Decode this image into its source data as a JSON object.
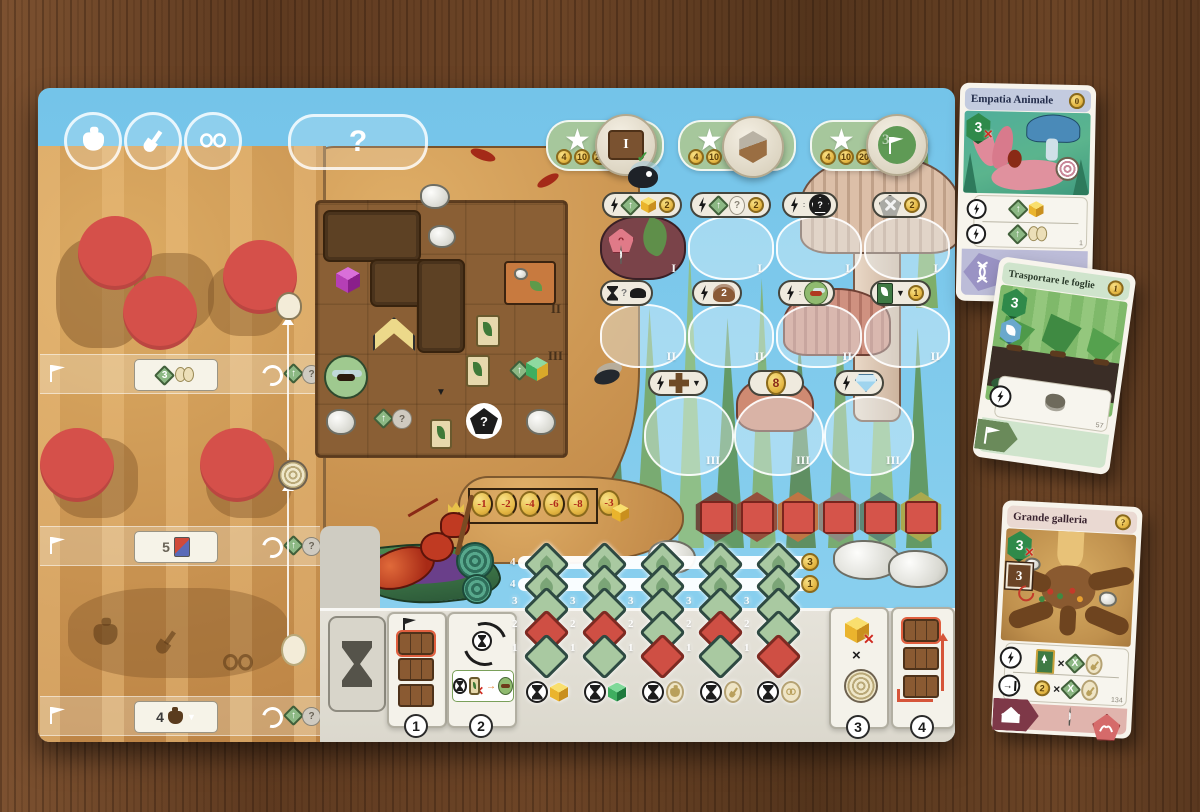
{
  "icons": {
    "question": "?",
    "star": "★",
    "up": "↑",
    "down": "▼",
    "check": "✓",
    "times": "×",
    "x": "X",
    "cross": "✕",
    "arrow_right": "→"
  },
  "board": {
    "score": {
      "coins": [
        "4",
        "10",
        "20"
      ],
      "tier_disc": "I",
      "flag_disc": "3"
    },
    "numerals": {
      "one": "I",
      "two": "II",
      "three": "III"
    },
    "slot_coins": {
      "r1c1": "2",
      "r1c2": "2",
      "r1c4": "2",
      "r2c4": "1"
    },
    "slot_badges": {
      "watcher": "2",
      "eight": "8"
    },
    "penalty": [
      "-1",
      "-2",
      "-4",
      "-6",
      "-8",
      "-3"
    ],
    "bands": [
      {
        "value": "3"
      },
      {
        "value": "5"
      },
      {
        "value": "4"
      }
    ],
    "track": {
      "top_labels": [
        "4",
        "4"
      ],
      "row_labels": [
        "3",
        "2",
        "1"
      ],
      "coins": [
        "3",
        "1"
      ]
    },
    "sections": [
      "1",
      "2",
      "3",
      "4"
    ]
  },
  "cards": {
    "empatia": {
      "title": "Empatia Animale",
      "coin": "0",
      "hex": "3",
      "number": "1"
    },
    "foglie": {
      "title": "Trasportare le foglie",
      "coin": "1",
      "hex": "3",
      "number": "57"
    },
    "galleria": {
      "title": "Grande galleria",
      "coin": "?",
      "hex": "3",
      "square": "3",
      "mult_coin": "2",
      "number": "134"
    }
  }
}
